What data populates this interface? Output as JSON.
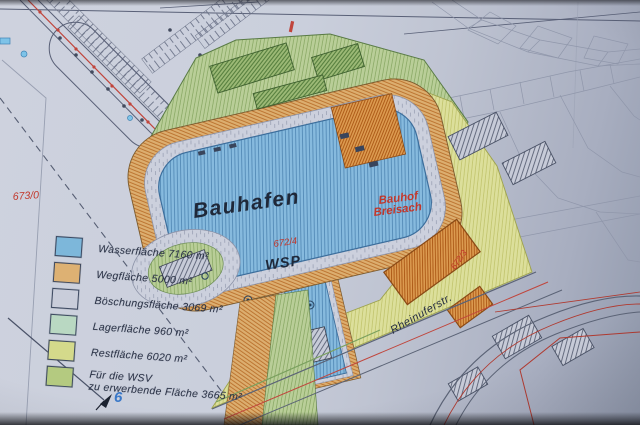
{
  "document": {
    "type": "site-plan-photo",
    "plan_subject": "Bauhafen Breisach harbour site plan"
  },
  "legend": {
    "items": [
      {
        "label": "Wasserfläche 7160 m²",
        "color": "#7db7da"
      },
      {
        "label": "Wegfläche 5000 m²",
        "color": "#ddb173"
      },
      {
        "label": "Böschungsfläche 3069 m²",
        "color": "#c9cdda"
      },
      {
        "label": "Lagerfläche 960 m²",
        "color": "#b9d8c2"
      },
      {
        "label": "Restfläche 6020 m²",
        "color": "#d4da8b"
      },
      {
        "label": "Für die WSV",
        "label2": "zu erwerbende Fläche 3665 m²",
        "color": "#b4ca80"
      }
    ]
  },
  "map": {
    "labels": {
      "harbor": "Bauhafen",
      "water_level": "WSP",
      "parcel_672_4": "672/4",
      "parcel_672_3": "672/3",
      "parcel_673_0": "673/0",
      "bauhof_line1": "Bauhof",
      "bauhof_line2": "Breisach",
      "street": "Rheinuferstr.",
      "survey_point": "6"
    },
    "colors": {
      "paper": "#cacfdc",
      "water": "#86bade",
      "water_hatch": "#4d84b2",
      "path_orange": "#dcae6f",
      "slope_gray": "#ccd0dd",
      "storage_green": "#b9ce98",
      "rest_yellow": "#dcdf9b",
      "wsv_building_green": "#9dba77",
      "bauhof_orange": "#dd9c51",
      "red_label": "#c2372b",
      "red_line": "#c0453c",
      "ink_line": "#596077",
      "survey_blue": "#3a78c8"
    }
  }
}
